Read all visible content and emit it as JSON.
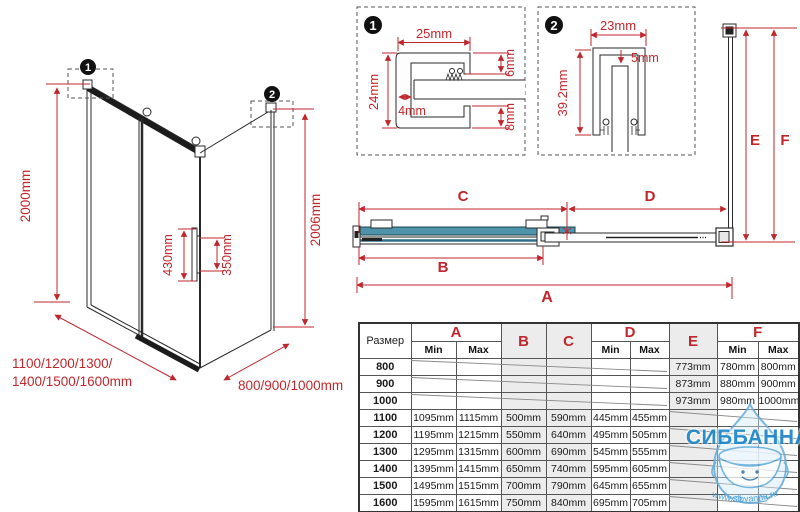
{
  "colors": {
    "dim_red": "#c0272d",
    "glass_teal": "#4f93aa",
    "watermark_blue": "#1d86c7"
  },
  "iso": {
    "callout1": "1",
    "callout2": "2",
    "height_left": "2000mm",
    "height_right": "2006mm",
    "handle_outer": "430mm",
    "handle_inner": "350mm",
    "width_line1": "1100/1200/1300/",
    "width_line2": "1400/1500/1600mm",
    "depth_label": "800/900/1000mm"
  },
  "detail1": {
    "num": "1",
    "width": "25mm",
    "height": "24mm",
    "top_gap": "6mm",
    "wall": "4mm",
    "bottom_gap": "8mm"
  },
  "detail2": {
    "num": "2",
    "width": "23mm",
    "gap": "5mm",
    "height": "39.2mm"
  },
  "plan": {
    "a": "A",
    "b": "B",
    "c": "C",
    "d": "D"
  },
  "wall": {
    "e": "E",
    "f": "F"
  },
  "table": {
    "size_header": "Размер",
    "min": "Min",
    "max": "Max",
    "letters": [
      "A",
      "B",
      "C",
      "D",
      "E",
      "F"
    ],
    "rows": [
      [
        "800",
        "",
        "",
        "",
        "",
        "",
        "",
        "773mm",
        "780mm",
        "800mm"
      ],
      [
        "900",
        "",
        "",
        "",
        "",
        "",
        "",
        "873mm",
        "880mm",
        "900mm"
      ],
      [
        "1000",
        "",
        "",
        "",
        "",
        "",
        "",
        "973mm",
        "980mm",
        "1000mm"
      ],
      [
        "1100",
        "1095mm",
        "1115mm",
        "500mm",
        "590mm",
        "445mm",
        "455mm",
        "",
        "",
        ""
      ],
      [
        "1200",
        "1195mm",
        "1215mm",
        "550mm",
        "640mm",
        "495mm",
        "505mm",
        "",
        "",
        ""
      ],
      [
        "1300",
        "1295mm",
        "1315mm",
        "600mm",
        "690mm",
        "545mm",
        "555mm",
        "",
        "",
        ""
      ],
      [
        "1400",
        "1395mm",
        "1415mm",
        "650mm",
        "740mm",
        "595mm",
        "605mm",
        "",
        "",
        ""
      ],
      [
        "1500",
        "1495mm",
        "1515mm",
        "700mm",
        "790mm",
        "645mm",
        "655mm",
        "",
        "",
        ""
      ],
      [
        "1600",
        "1595mm",
        "1615mm",
        "750mm",
        "840mm",
        "695mm",
        "705mm",
        "",
        "",
        ""
      ]
    ]
  },
  "watermark": {
    "brand": "СИББАННА",
    "url": "www.sibvanna.ru"
  }
}
